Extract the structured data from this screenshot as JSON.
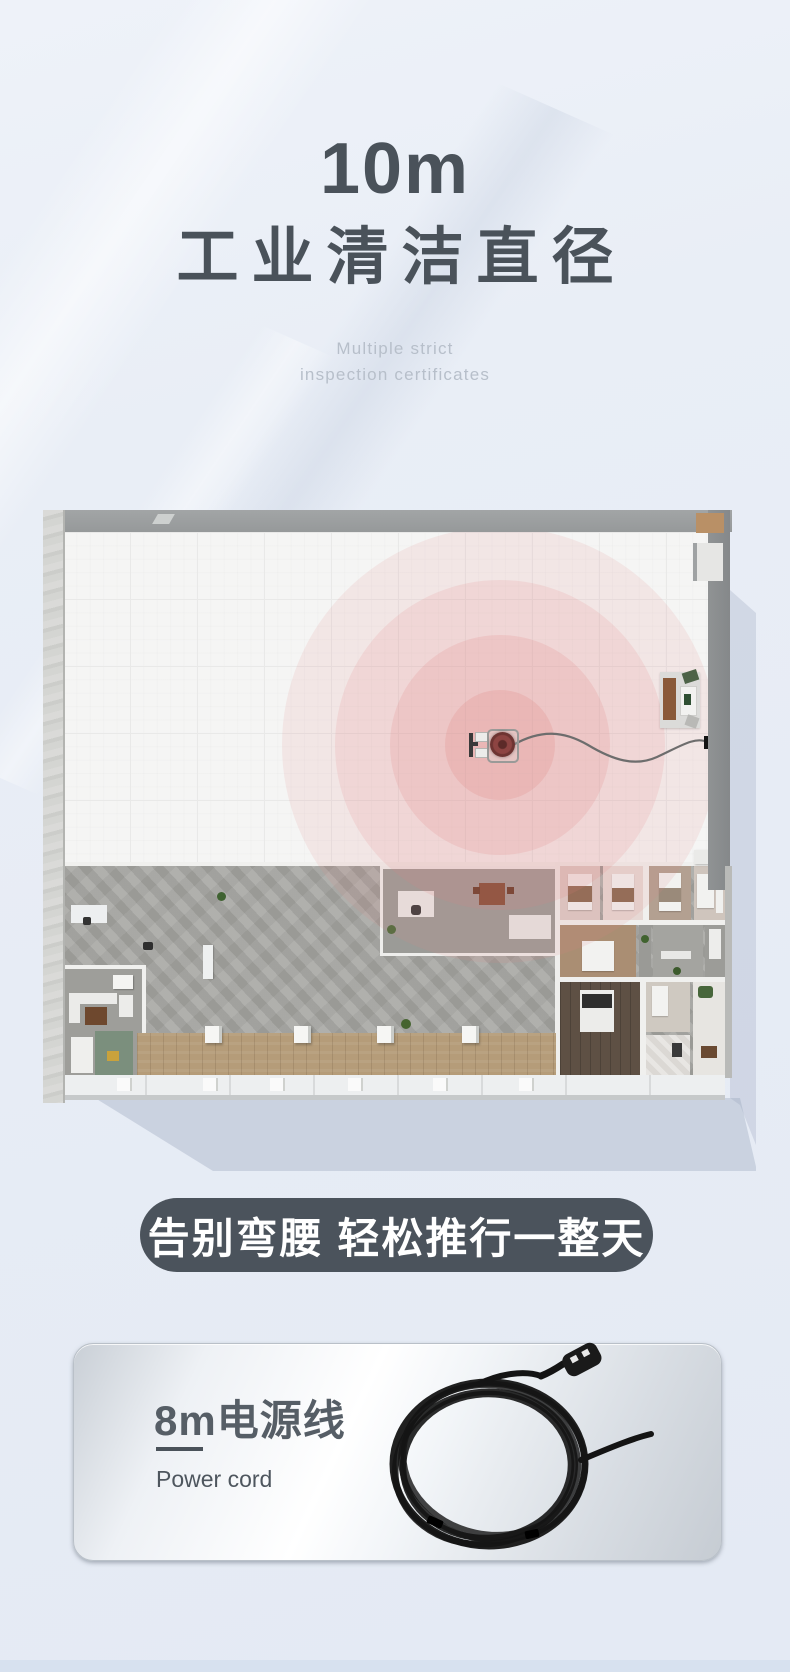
{
  "header": {
    "title_line1": "10m",
    "title_line2": "工业清洁直径",
    "tagline_line1": "Multiple strict",
    "tagline_line2": "inspection certificates",
    "title_color": "#4a525a",
    "tagline_color": "#b7bfca"
  },
  "floorplan": {
    "ring_color": "#e18280",
    "wall_color": "#96999a",
    "tile_floor_color": "#f5f5f4",
    "concrete_floor_color": "#a7a7a3",
    "wood_floor_color": "#b59c79"
  },
  "banner": {
    "text": "告别弯腰 轻松推行一整天",
    "background_color": "#4b535c",
    "text_color": "#ffffff"
  },
  "card": {
    "title": "8m电源线",
    "subtitle": "Power cord",
    "title_color": "#565e66",
    "divider_color": "#4a525a"
  },
  "footer": {
    "next_section_color": "#d7e1ef"
  }
}
